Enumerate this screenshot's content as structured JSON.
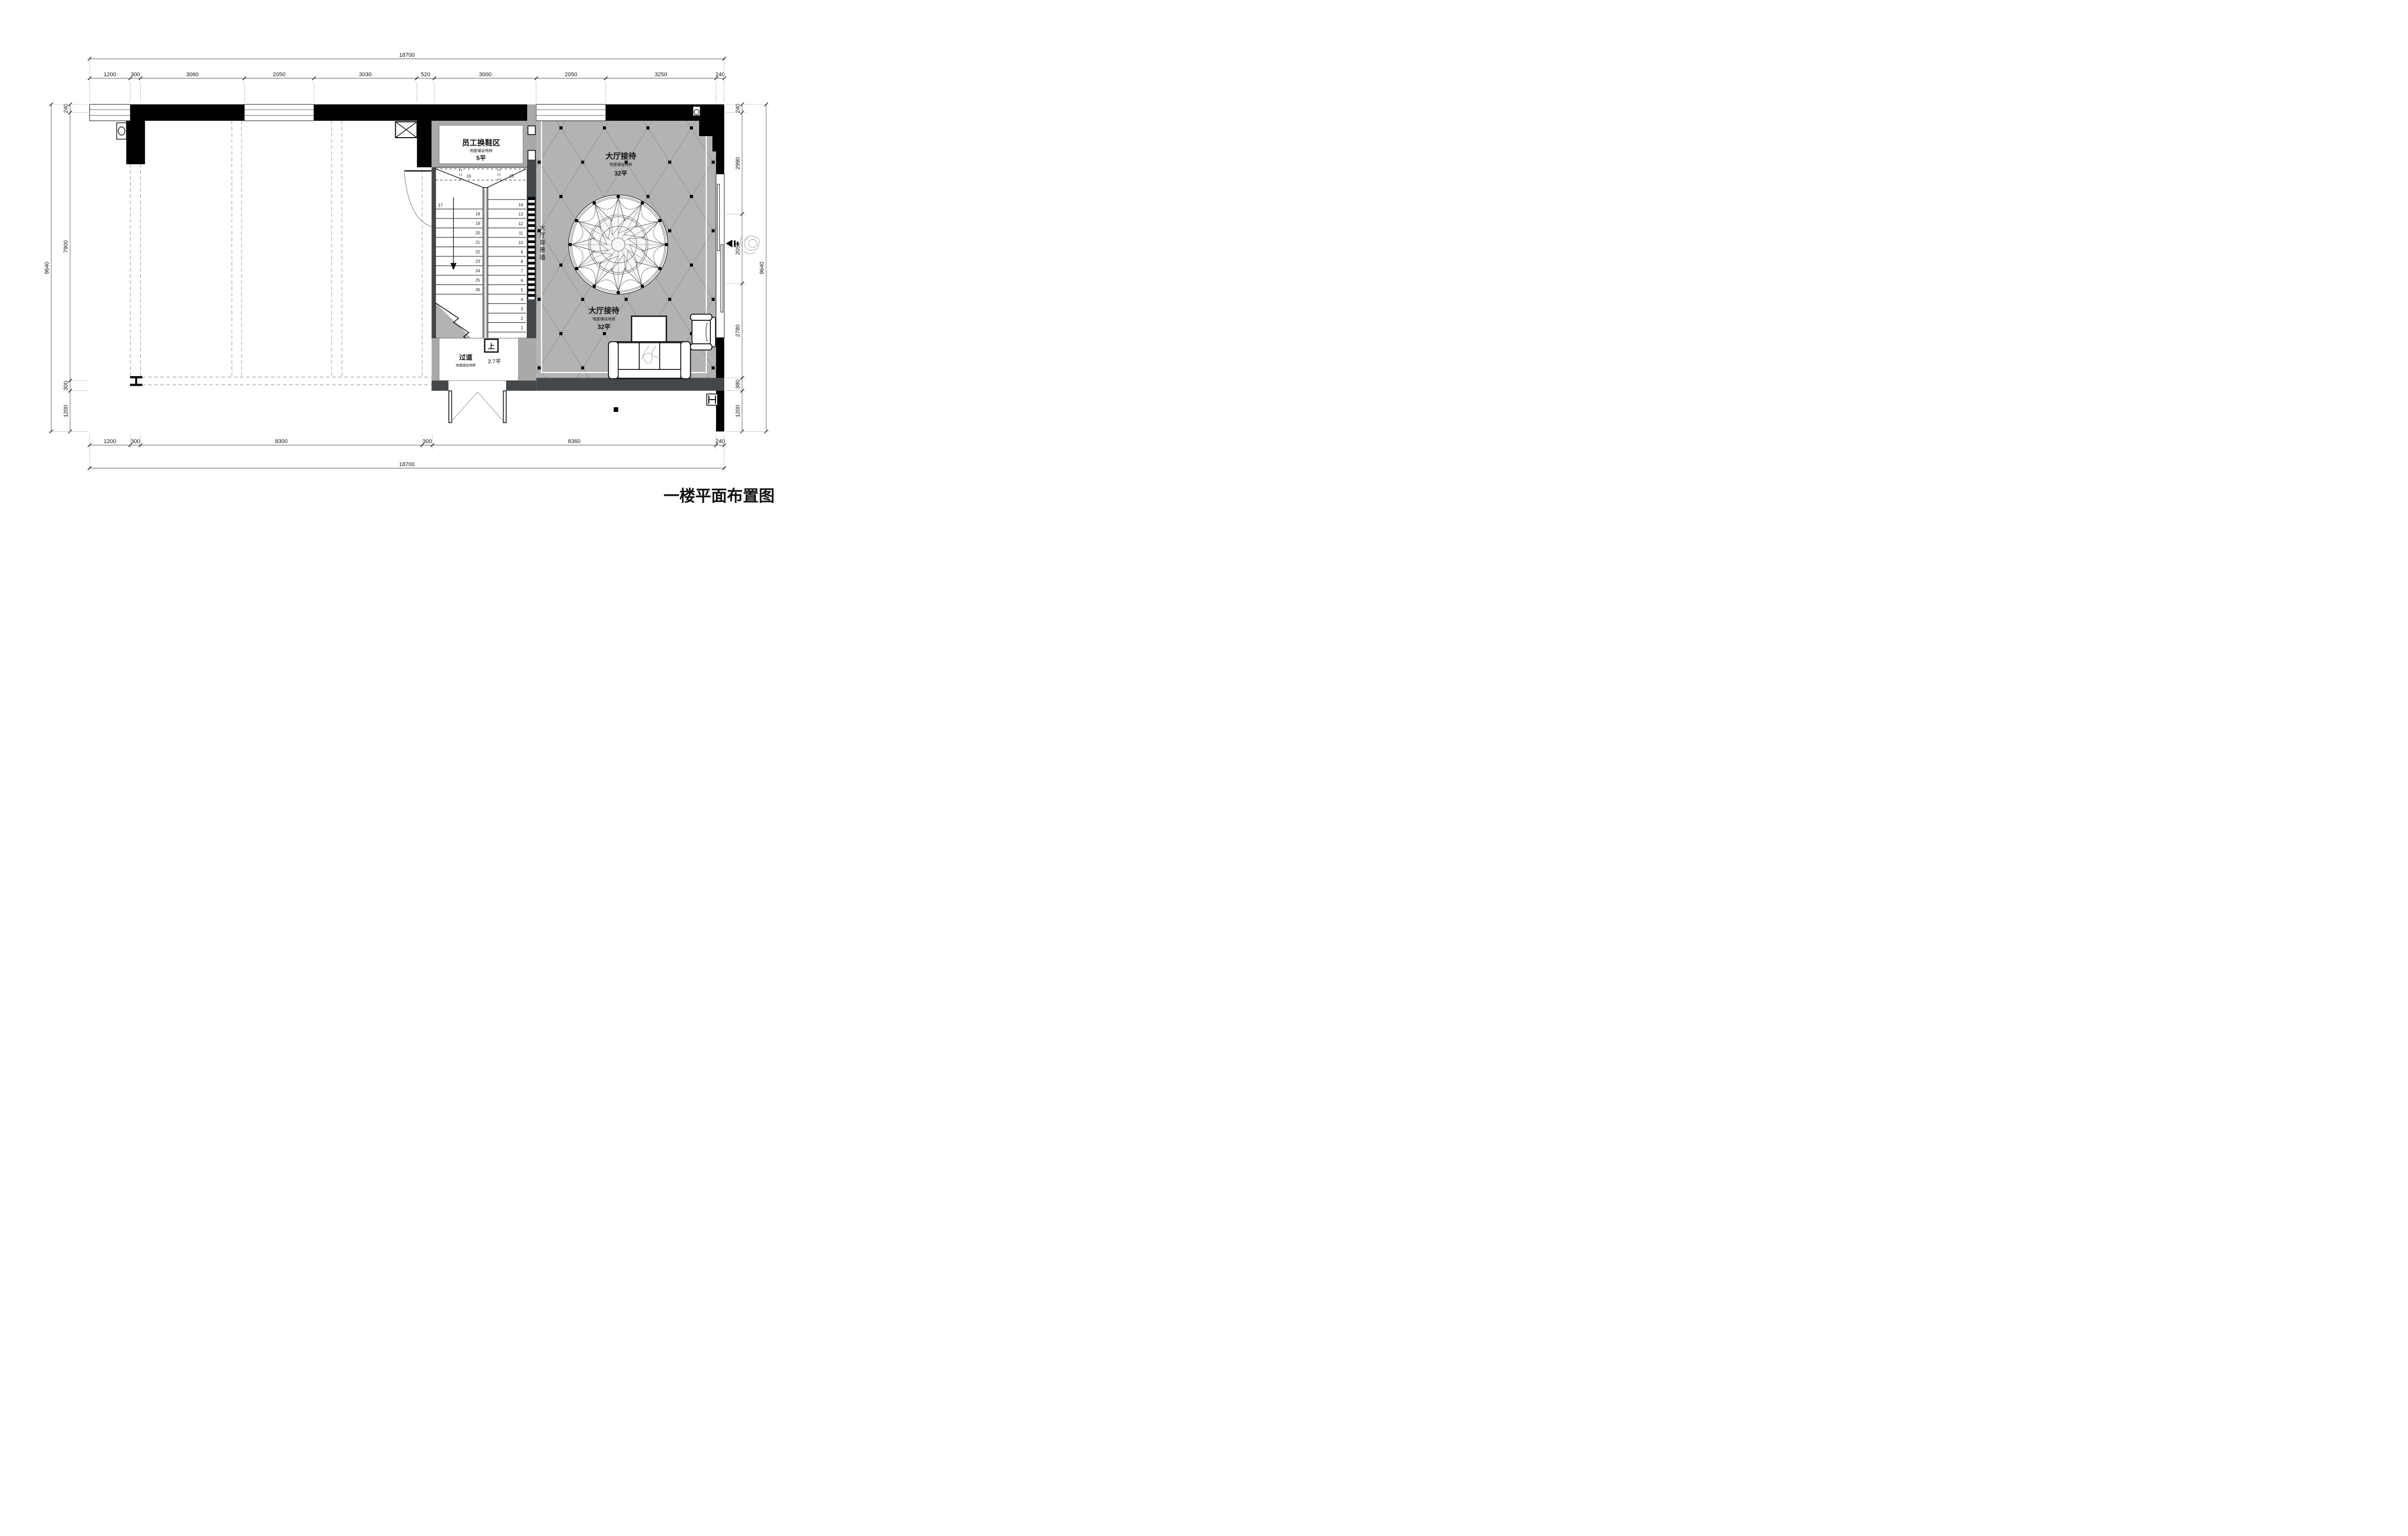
{
  "title": "一楼平面布置图",
  "rooms": {
    "staff_shoe_area": {
      "name": "员工换鞋区",
      "floor_note": "地面铺设地砖",
      "area": "5平"
    },
    "hall": {
      "name": "大厅接待",
      "floor_note": "地面铺设地砖",
      "area": "32平"
    },
    "corridor": {
      "name": "过道",
      "floor_note": "地面铺设地砖",
      "area": "3.7平"
    },
    "background_wall_label": "大厅背景墙",
    "stair_up_label": "上"
  },
  "stairs": {
    "top_row": [
      "16",
      "15"
    ],
    "left_flight": [
      "17",
      "18",
      "19",
      "20",
      "21",
      "22",
      "23",
      "24",
      "25",
      "26"
    ],
    "right_flight": [
      "14",
      "13",
      "12",
      "11",
      "10",
      "9",
      "8",
      "7",
      "6",
      "5",
      "4",
      "3",
      "2",
      "1"
    ]
  },
  "dimensions": {
    "top": {
      "overall": "18700",
      "chain": [
        "1200",
        "300",
        "3060",
        "2050",
        "3030",
        "520",
        "3000",
        "2050",
        "3250",
        "240"
      ]
    },
    "bottom": {
      "overall": "18700",
      "chain": [
        "1200",
        "300",
        "8300",
        "300",
        "8360",
        "240"
      ]
    },
    "left": {
      "overall": "9640",
      "chain": [
        "240",
        "7900",
        "300",
        "1200"
      ]
    },
    "right": {
      "overall": "9640",
      "chain": [
        "240",
        "2990",
        "2050",
        "2780",
        "380",
        "1200"
      ]
    }
  },
  "colors": {
    "wall_black": "#000000",
    "partition_gray": "#a9a9a9",
    "dark_wall": "#44484b",
    "floor_gray": "#b3b3b3",
    "paper": "#ffffff",
    "line": "#1a1a1a"
  }
}
